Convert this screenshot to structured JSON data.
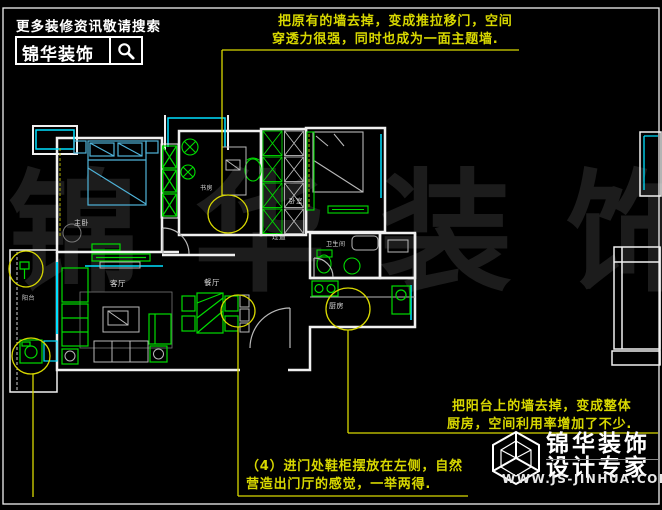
{
  "colors": {
    "background": "#000000",
    "wall": "#f0f0f0",
    "window": "#00e0ff",
    "furniture": "#00dc00",
    "annotation": "#d8d800",
    "watermark": "#1c1c1c"
  },
  "icons": {
    "search": "magnifier-glass",
    "footer_logo": "wireframe-cube"
  },
  "header": {
    "tagline": "更多装修资讯敬请搜索",
    "brand": "锦华装饰"
  },
  "watermark": {
    "text": "锦 华 装 饰"
  },
  "plan": {
    "rooms": [
      {
        "label": "主卧"
      },
      {
        "label": "书房"
      },
      {
        "label": "卧室"
      },
      {
        "label": "过道"
      },
      {
        "label": "卫生间"
      },
      {
        "label": "客厅"
      },
      {
        "label": "餐厅"
      },
      {
        "label": "厨房"
      },
      {
        "label": "阳台"
      }
    ]
  },
  "annotations": {
    "top": {
      "line1": "把原有的墙去掉，变成推拉移门，空间",
      "line2": "穿透力很强，同时也成为一面主题墙."
    },
    "kitchen": {
      "line1": "把阳台上的墙去掉，变成整体",
      "line2": "厨房，空间利用率增加了不少."
    },
    "entry": {
      "line1": "（4）进门处鞋柜摆放在左侧，自然",
      "line2": "营造出门厅的感觉，一举两得."
    }
  },
  "footer": {
    "brand": "锦华装饰",
    "subtitle": "设计专家",
    "website": "WWW.JS-JINHUA.COM"
  }
}
